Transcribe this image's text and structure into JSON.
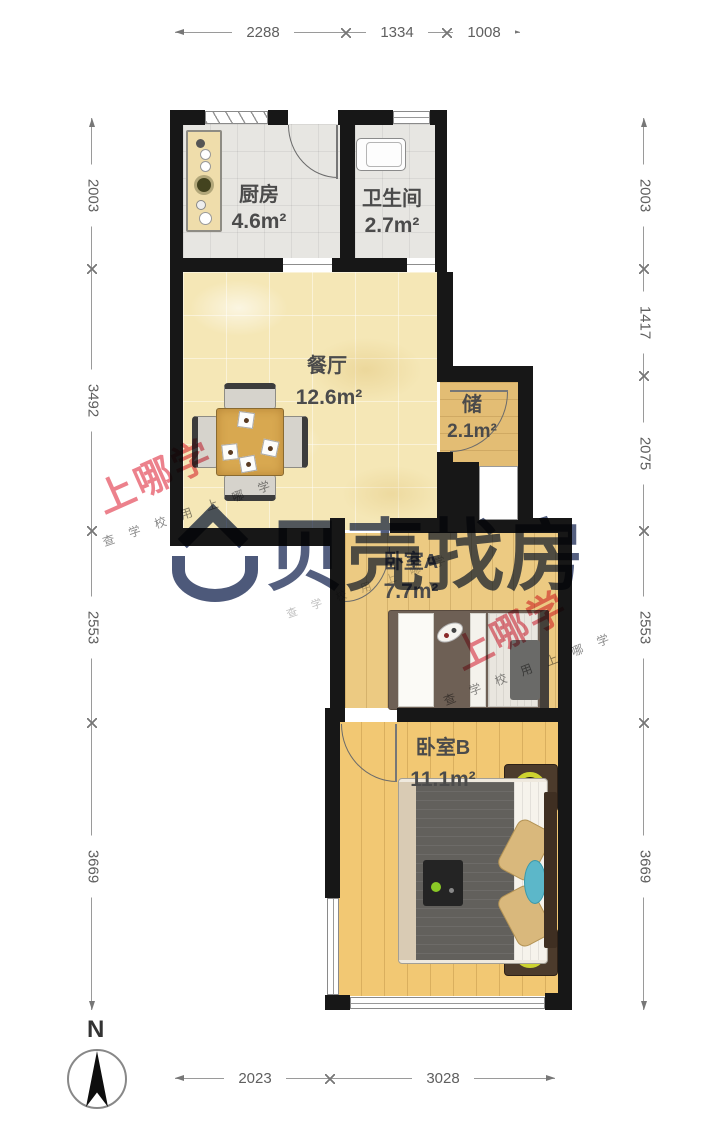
{
  "rooms": {
    "kitchen": {
      "name": "厨房",
      "area": "4.6m²"
    },
    "bathroom": {
      "name": "卫生间",
      "area": "2.7m²"
    },
    "dining": {
      "name": "餐厅",
      "area": "12.6m²"
    },
    "storage": {
      "name": "储",
      "area": "2.1m²"
    },
    "bedroom_a": {
      "name": "卧室A",
      "area": "7.7m²"
    },
    "bedroom_b": {
      "name": "卧室B",
      "area": "11.1m²"
    }
  },
  "dimensions": {
    "top": {
      "d1": "2288",
      "d2": "1334",
      "d3": "1008"
    },
    "bottom": {
      "d1": "2023",
      "d2": "3028"
    },
    "left": {
      "d1": "2003",
      "d2": "3492",
      "d3": "2553",
      "d4": "3669"
    },
    "right": {
      "d1": "2003",
      "d2": "1417",
      "d3": "2075",
      "d4": "2553",
      "d5": "3669"
    }
  },
  "compass": {
    "label": "N"
  },
  "watermarks": {
    "red": {
      "main": "上哪学",
      "sub": "查 学 校 用 上 哪 学"
    },
    "blue": {
      "text": "贝壳找房"
    }
  },
  "colors": {
    "wall": "#171717",
    "dining_floor": "#f5e7b6",
    "wood_floor": "#f2c873",
    "tile_floor": "#e7e6e2",
    "red_watermark": "#e75d6b",
    "blue_watermark": "#2e3b63",
    "lamp_yellow": "#cdd32f",
    "teal_accent": "#5cb7c9"
  }
}
